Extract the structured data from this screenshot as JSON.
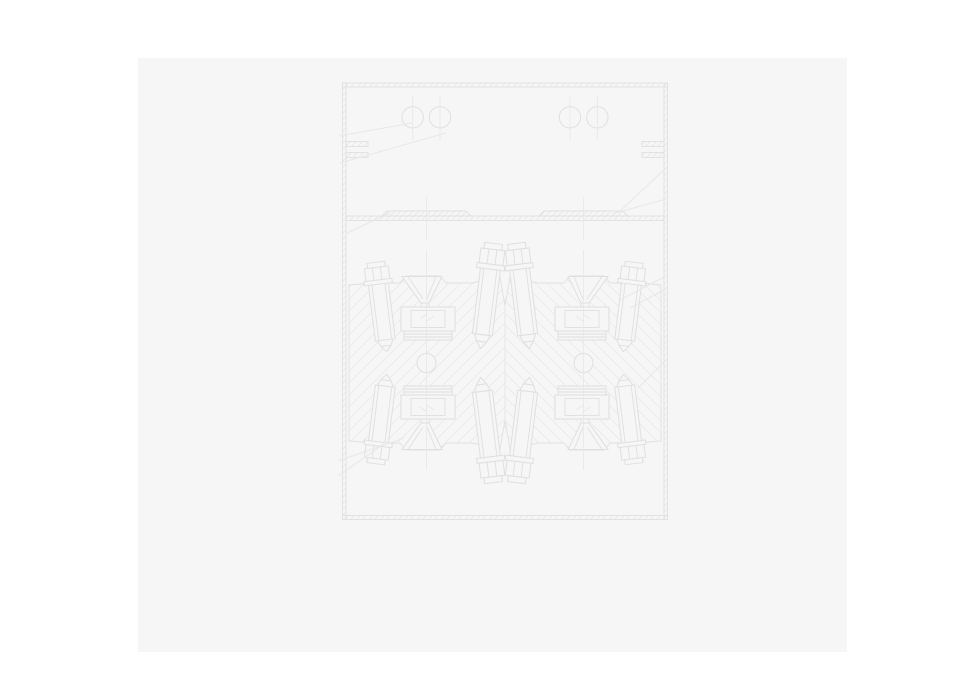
{
  "document": {
    "type": "technical-drawing",
    "description": "Very faint grey sectional CAD drawing of a symmetric bolted mold/press housing: upper chamber with two pairs of bolt-hole circles, a horizontal divider plate with two flat bars, and a lower sectioned body holding four mirrored stud-and-nut assemblies around two pivot circles, with diagonal section hatching and leader lines.",
    "visible_text": []
  },
  "colors": {
    "canvas": "#ffffff",
    "page": "#f6f6f6",
    "line": "#e0e0e0",
    "partline": "#dfdfdf",
    "line2": "#e7e7e7",
    "hatch": "#e9e9e9"
  },
  "drawing": {
    "parts": [
      "housing-frame-with-section-ticks",
      "left-wall-flange-notch",
      "right-wall-flange-notch",
      "top-chamber-bolt-circles (4, r≈11px)",
      "divider-plate",
      "left-flat-bar",
      "right-flat-bar",
      "hatched-body-left-half",
      "hatched-body-right-half",
      "stud-with-nut-assemblies (8, mirrored quadrants)",
      "funnel-gate-and-block (4, mirrored quadrants)",
      "pivot-circle-left",
      "pivot-circle-right",
      "centerlines",
      "leader-lines"
    ]
  }
}
